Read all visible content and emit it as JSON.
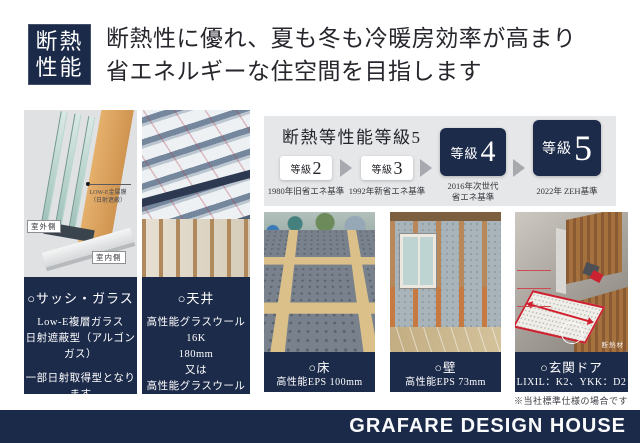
{
  "colors": {
    "navy": "#1d2b4b",
    "panel_gray": "#e6e7e9",
    "arrow_gray": "#a7a9ae",
    "accent_red": "#cc2130",
    "background": "#ffffff"
  },
  "header": {
    "badge_line1": "断熱",
    "badge_line2": "性能",
    "title_line1": "断熱性に優れ、夏も冬も冷暖房効率が高まり",
    "title_line2": "省エネルギーな住空間を目指します"
  },
  "grade_panel": {
    "title": "断熱等性能等級5",
    "grades": [
      {
        "prefix": "等級",
        "number": "2",
        "caption_lines": [
          "1980年旧省エネ基準"
        ]
      },
      {
        "prefix": "等級",
        "number": "3",
        "caption_lines": [
          "1992年新省エネ基準"
        ]
      },
      {
        "prefix": "等級",
        "number": "4",
        "caption_lines": [
          "2016年次世代",
          "省エネ基準"
        ]
      },
      {
        "prefix": "等級",
        "number": "5",
        "caption_lines": [
          "2022年 ZEH基準"
        ]
      }
    ]
  },
  "sash_diagram": {
    "outdoor_label": "室外側",
    "indoor_label": "室内側",
    "glass_label_line1": "LOW-E金属膜",
    "glass_label_line2": "（日射遮蔽）"
  },
  "door_diagram": {
    "material_label": "断熱材"
  },
  "captions": {
    "sash": {
      "title": "○サッシ・ガラス",
      "block1": [
        "Low-E複層ガラス",
        "日射遮蔽型（アルゴンガス）"
      ],
      "block2": [
        "一部日射取得型となります",
        "アルミ樹脂複合サッシ"
      ]
    },
    "ceiling": {
      "title": "○天井",
      "lines": [
        "高性能グラスウール16K",
        "180mm",
        "又は",
        "高性能グラスウール24K",
        "155mm"
      ]
    },
    "floor": {
      "title": "○床",
      "line": "高性能EPS 100mm"
    },
    "wall": {
      "title": "○壁",
      "line": "高性能EPS 73mm"
    },
    "door": {
      "title": "○玄関ドア",
      "line": "LIXIL：K2、YKK：D2"
    }
  },
  "note": "※当社標準仕様の場合です",
  "footer": {
    "brand": "GRAFARE DESIGN HOUSE"
  }
}
